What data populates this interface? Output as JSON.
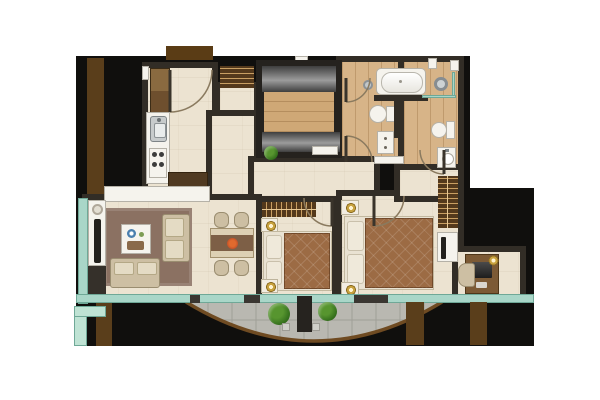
{
  "scene": {
    "kind": "apartment-floor-plan",
    "description": "Top-down rendered 2-bedroom apartment floor plan with curved balcony",
    "visible_text": []
  },
  "palette": {
    "slab": "#100f0d",
    "wall": "#322d26",
    "floor": "#ece3d1",
    "wood": "#d7b488",
    "woodMid": "#cfa876",
    "fixture": "#f5f3ed",
    "fixtureEdge": "#b5b1a7",
    "glass": "#a9d6c8",
    "glassEdge": "#6fa897",
    "stone": "#b9b8b1",
    "stoneLine": "#a09f97",
    "rim": "#6f4b22",
    "rug": "#8b7162",
    "sofa": "#cdbfa3",
    "cushion": "#e4dbc4",
    "duvet": "#9c6b44",
    "pillow": "#efe9da",
    "bedbase": "#e9e2d2",
    "nsWhite": "#f2ede2",
    "closet": "#54391c",
    "hanger": "#c99f63",
    "fin": "#5a3e1b",
    "mat": "#5a3c15",
    "plant": "#57952f",
    "plantDeep": "#346f1c",
    "gold": "#c8a23e",
    "tv": "#23211d",
    "glossA": "#3e3e3e",
    "glossB": "#9c9c9c",
    "desk": "#7c5a35",
    "steel": "#c7cbcc",
    "bowlRed": "#c2522a",
    "decorBlue": "#4a7fae"
  },
  "rooms": [
    {
      "id": "foyer-kitchen"
    },
    {
      "id": "entry-closet"
    },
    {
      "id": "hallway"
    },
    {
      "id": "utility-core"
    },
    {
      "id": "bathroom-main"
    },
    {
      "id": "bathroom-ensuite"
    },
    {
      "id": "living-room"
    },
    {
      "id": "dining-area"
    },
    {
      "id": "bedroom-1"
    },
    {
      "id": "bedroom-2"
    },
    {
      "id": "desk-nook"
    },
    {
      "id": "balcony"
    }
  ],
  "furniture": [
    {
      "id": "entry-door"
    },
    {
      "id": "kitchen-cabinets"
    },
    {
      "id": "kitchen-sink"
    },
    {
      "id": "kitchen-stove"
    },
    {
      "id": "kitchen-counter"
    },
    {
      "id": "bathtub"
    },
    {
      "id": "shower"
    },
    {
      "id": "toilet-main"
    },
    {
      "id": "toilet-ensuite"
    },
    {
      "id": "bathroom-cabinet"
    },
    {
      "id": "vanity-sink"
    },
    {
      "id": "bed-1"
    },
    {
      "id": "bed-2"
    },
    {
      "id": "nightstands"
    },
    {
      "id": "wardrobe"
    },
    {
      "id": "tv-unit"
    },
    {
      "id": "dining-table"
    },
    {
      "id": "dining-chairs"
    },
    {
      "id": "sofa"
    },
    {
      "id": "loveseat"
    },
    {
      "id": "coffee-table"
    },
    {
      "id": "tv-panel"
    },
    {
      "id": "media-cabinet"
    },
    {
      "id": "area-rug"
    },
    {
      "id": "desk"
    },
    {
      "id": "desk-chair"
    },
    {
      "id": "balcony-plants"
    },
    {
      "id": "balcony-divider"
    },
    {
      "id": "glass-wall"
    },
    {
      "id": "parapet"
    }
  ]
}
